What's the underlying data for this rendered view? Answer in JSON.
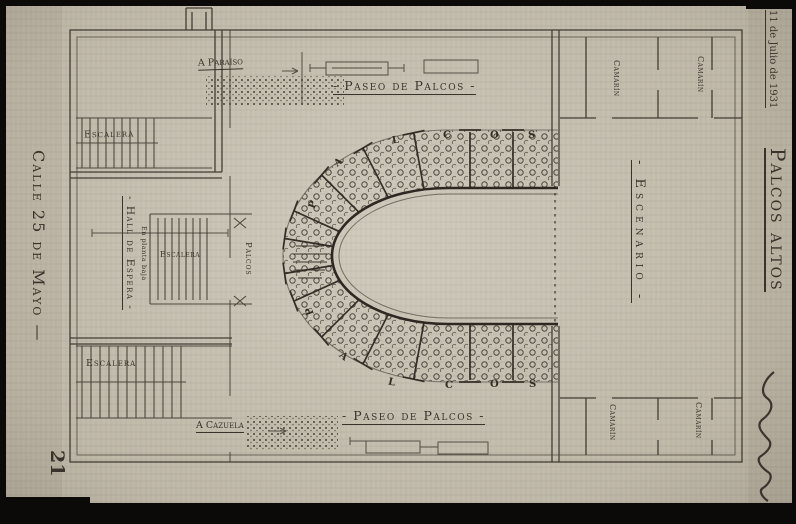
{
  "document": {
    "page_number": "21",
    "margin_left": {
      "street_label": "Calle 25 de Mayo —"
    },
    "margin_right": {
      "date_note": "11 de Julio de 1931",
      "title": "Palcos altos"
    }
  },
  "plan": {
    "promenade_top": "- Paseo de Palcos -",
    "promenade_bottom": "- Paseo de Palcos -",
    "stage_label": "- Escenario -",
    "waiting_hall_label": "- Hall de Espera -",
    "waiting_hall_note": "En planta baja",
    "boxes_corridor_label": "Palcos",
    "stair_top_label": "Escalera",
    "stair_middle_label": "Escalera",
    "stair_bottom_label": "Escalera",
    "to_paradise_gallery": "A Paraíso",
    "to_cazuela_gallery": "A Cazuela",
    "dressing_rooms": [
      "Camarín",
      "Camarín",
      "Camarín",
      "Camarín"
    ],
    "box_tier_letters_top": [
      "P",
      "A",
      "L",
      "C",
      "O",
      "S"
    ],
    "box_tier_letters_bottom": [
      "P",
      "A",
      "L",
      "C",
      "O",
      "S"
    ]
  },
  "colors": {
    "paper": "#c8c2b4",
    "ink": "#3a332b",
    "scan_border": "#0b0a08"
  }
}
